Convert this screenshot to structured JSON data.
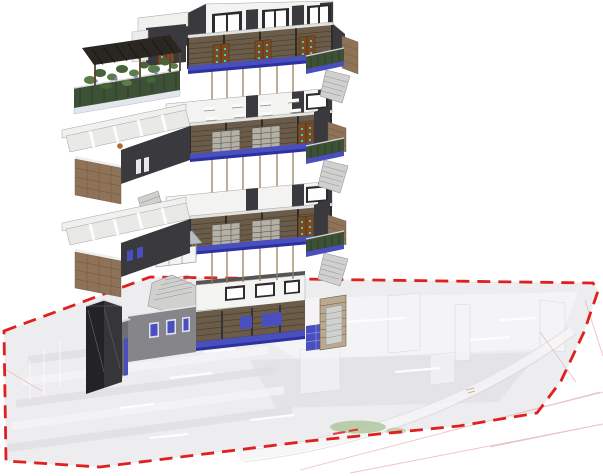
{
  "scene": {
    "type": "exploded-axonometric-building-model",
    "levels_count": 4,
    "boundary_style": "red-dashed-site-boundary"
  },
  "levels": [
    {
      "name": "roof-terrace-level"
    },
    {
      "name": "upper-floor-level"
    },
    {
      "name": "middle-floor-level"
    },
    {
      "name": "ground-floor-and-site"
    }
  ],
  "colors": {
    "white_wall": "#f3f3f1",
    "wall_edge": "#a2a2a0",
    "dark_wall": "#3a3a3e",
    "darker_wall": "#232327",
    "window_frame": "#2c2c30",
    "wood_slat": "#6b5c49",
    "wood_slat_dark": "#4b4033",
    "wood_door": "#7a4a22",
    "door_edge": "#4e2d12",
    "door_glass_teal": "#3fc8c4",
    "blue_glass": "#4a4fc0",
    "blue_glass_dark": "#2c31a0",
    "brick": "#8f7358",
    "brick_line": "#6e5742",
    "green_rail": "#3d5136",
    "green_dark": "#2a3a26",
    "foliage": "#5c7c48",
    "foliage_dark": "#466339",
    "flower_purple": "#7e82cc",
    "pergola": "#2a2622",
    "wood_post": "#5a4330",
    "stair": "#d0d0ce",
    "stair_edge": "#96969a",
    "gray_wall": "#85858a",
    "gray_wall_dark": "#6e6e74",
    "floor_top": "#e9e9e7",
    "desk_white": "#fafaf8",
    "ghost_fill": "#eaeaed",
    "ghost_fill2": "#e0e0e4",
    "ghost_wall": "#f5f5f7",
    "ghost_edge": "#d6d6da",
    "site_line_pink": "#e9bcbc",
    "boundary_red": "#e01f1f",
    "column_line": "#9c7f5c",
    "canopy_glass": "#cfe0e8",
    "slat_window": "#b5b0a6",
    "table_orange": "#b06a30"
  }
}
